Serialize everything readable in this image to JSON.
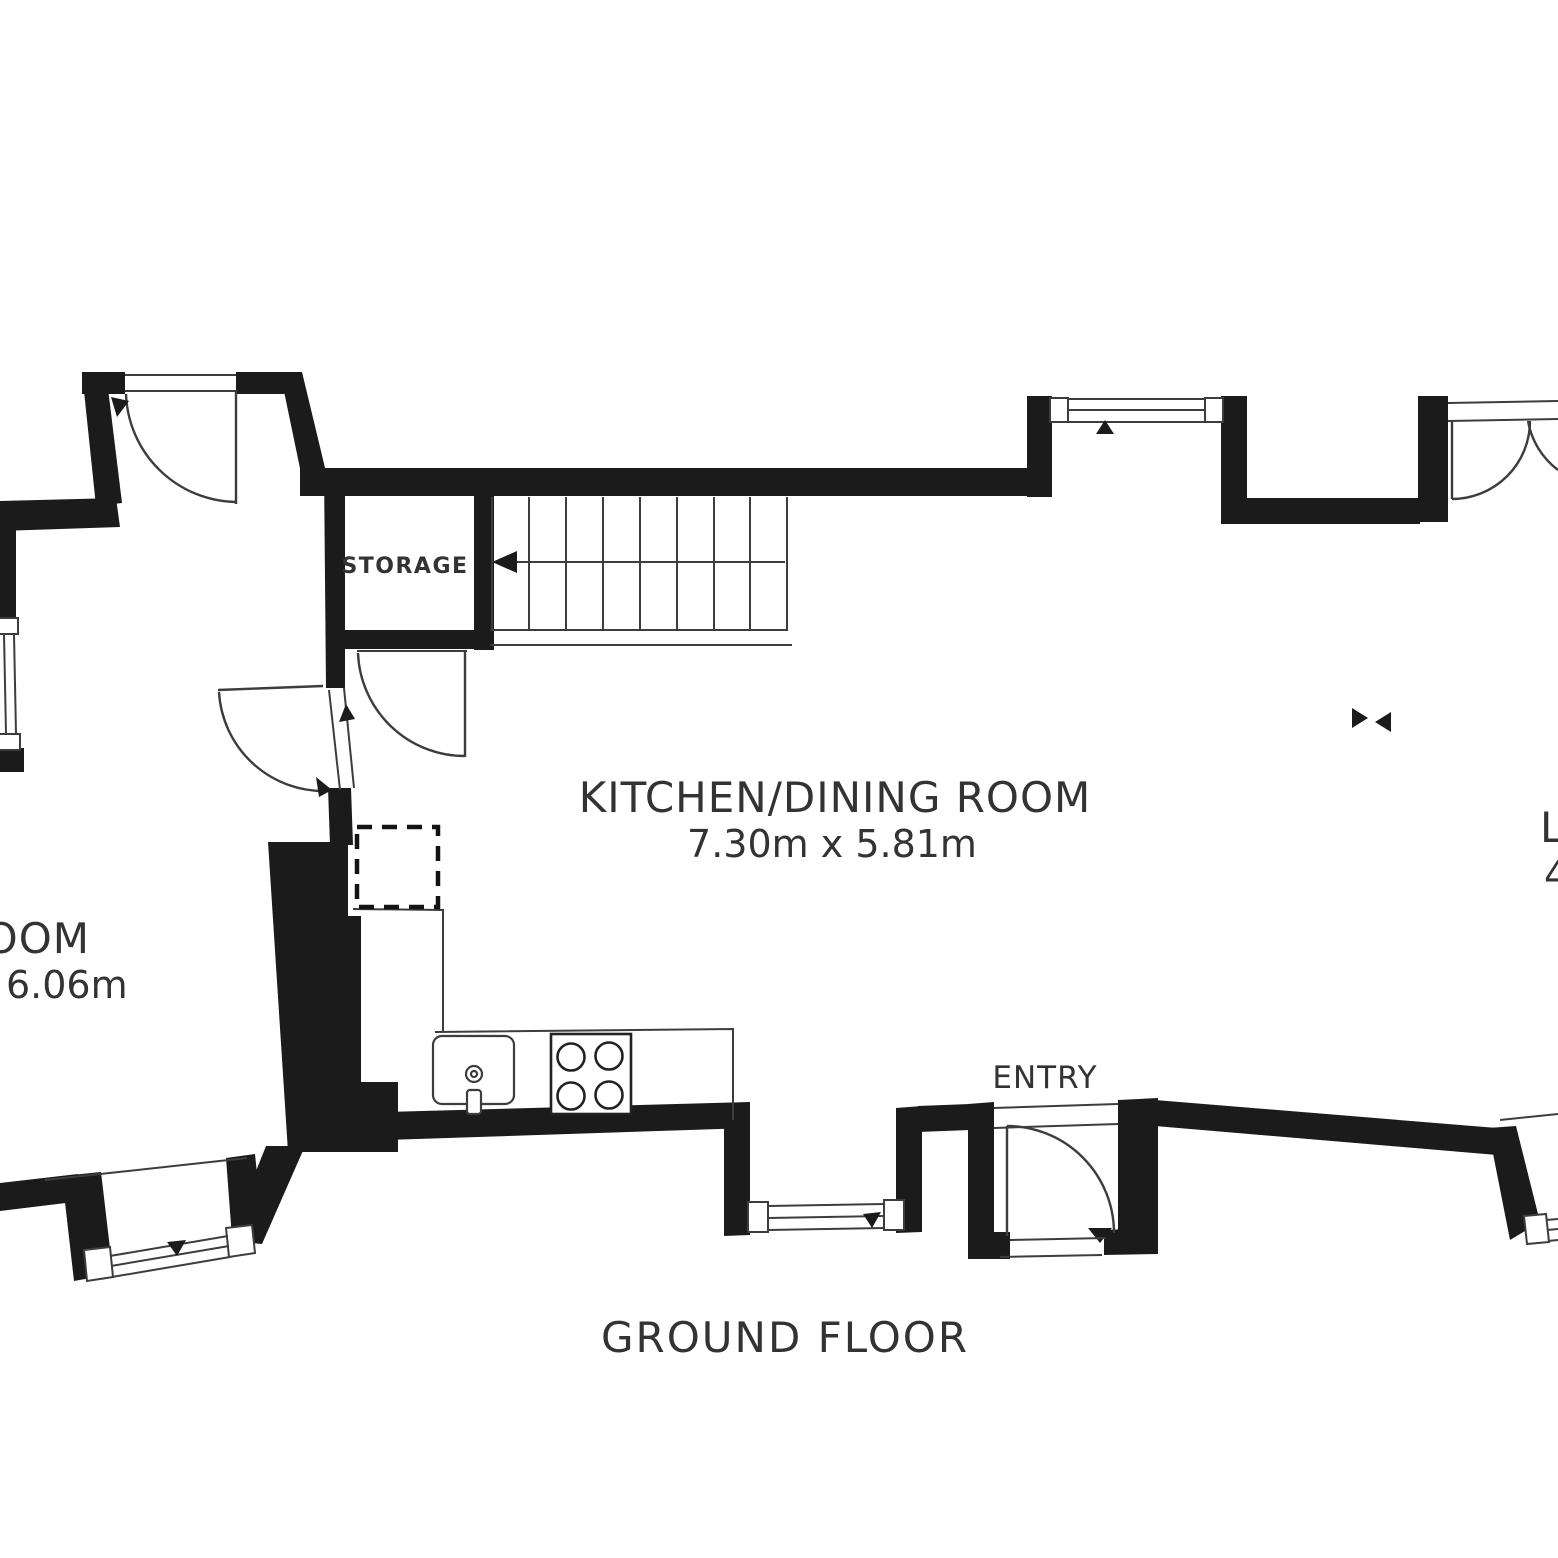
{
  "title": {
    "label": "GROUND FLOOR"
  },
  "rooms": {
    "kitchen_dining": {
      "name": "KITCHEN/DINING ROOM",
      "dimensions": "7.30m x 5.81m"
    },
    "storage": {
      "name": "STORAGE"
    },
    "entry": {
      "name": "ENTRY"
    },
    "left_room": {
      "name_visible": "OOM",
      "dimensions_visible": "6.06m"
    },
    "right_room": {
      "name_visible": "L",
      "dimensions_visible": "4"
    }
  },
  "icons": {
    "stairs_arrow": "stairs-direction-arrow",
    "door_swing_arrow": "door-swing-arrow",
    "window_marker": "window-opening-triangle",
    "opening_markers": "opening-direction-triangles"
  },
  "colors": {
    "wall": "#1b1b1b",
    "line": "#3d3d3d",
    "text": "#333333",
    "background": "#ffffff"
  }
}
